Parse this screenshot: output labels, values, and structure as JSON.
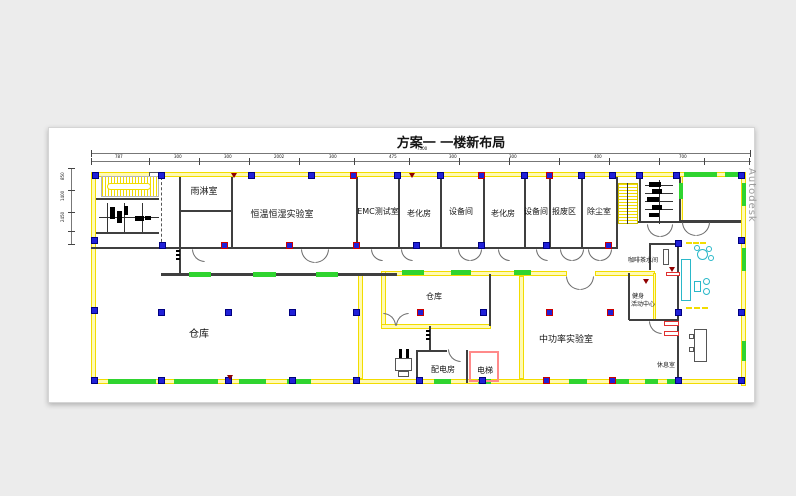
{
  "title": "方案一  一楼新布局",
  "watermark": "Autodesk",
  "rooms": {
    "rain": "雨淋室",
    "climate": "恒温恒湿实验室",
    "emc": "EMC测试室",
    "aging1": "老化房",
    "equip1": "设备间",
    "aging2": "老化房",
    "equip2": "设备间",
    "scrap": "报废区",
    "dust": "除尘室",
    "warehouse_big": "仓库",
    "warehouse_small": "仓库",
    "power": "配电房",
    "elevator": "电梯",
    "midpower": "中功率实验室",
    "coffee": "咖啡茶水间",
    "fitness_line1": "健身",
    "fitness_line2": "活动中心",
    "rest": "休息室"
  },
  "dimensions": {
    "top_total": "7500",
    "top_segments": [
      "787",
      "300",
      "300",
      "2002",
      "300",
      "475",
      "300",
      "300",
      "400",
      "700"
    ],
    "left_segments": [
      "850",
      "1400",
      "2450"
    ]
  },
  "colors": {
    "wall_yellow": "#f2dc00",
    "window_green": "#2fd42f",
    "column_blue": "#2020d8",
    "column_red_border": "#cc0000",
    "furniture_cyan": "#2ab8c9",
    "elevator_red": "#ff8a8a"
  }
}
